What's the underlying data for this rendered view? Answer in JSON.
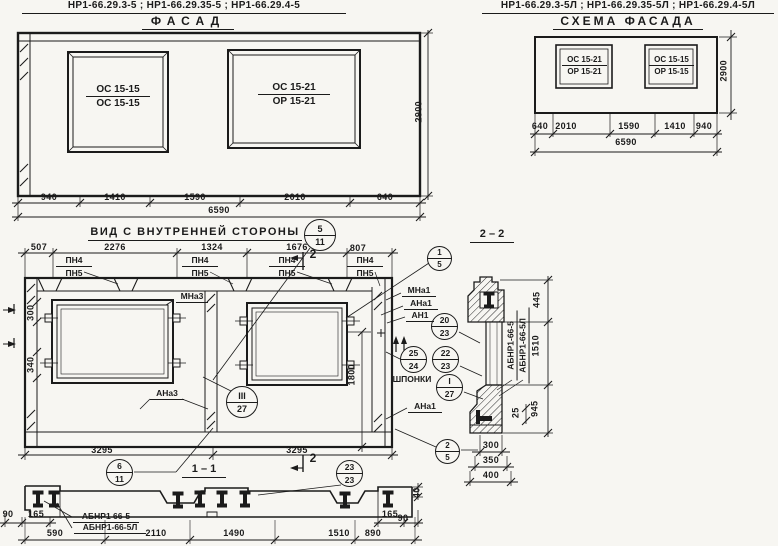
{
  "colors": {
    "ink": "#1b1b1b",
    "paper": "#f7f6f2"
  },
  "facade": {
    "codes": "НР1-66.29.3-5 ; НР1-66.29.35-5 ; НР1-66.29.4-5",
    "title": "ФАСАД",
    "win_left": {
      "top": "ОС 15-15",
      "bottom": "ОС 15-15"
    },
    "win_right": {
      "top": "ОС 15-21",
      "bottom": "ОР 15-21"
    },
    "dims": [
      "940",
      "1410",
      "1590",
      "2010",
      "640"
    ],
    "total": "6590",
    "height": "2900"
  },
  "schema": {
    "codes": "НР1-66.29.3-5Л ; НР1-66.29.35-5Л ; НР1-66.29.4-5Л",
    "title": "СХЕМА ФАСАДА",
    "win_left": {
      "top": "ОС 15-21",
      "bottom": "ОР 15-21"
    },
    "win_right": {
      "top": "ОС 15-15",
      "bottom": "ОР 15-15"
    },
    "dims": [
      "640",
      "2010",
      "1590",
      "1410",
      "940"
    ],
    "total": "6590",
    "height": "2900"
  },
  "inner": {
    "title": "ВИД С ВНУТРЕННЕЙ СТОРОНЫ",
    "dims_top": [
      "507",
      "2276",
      "1324",
      "1676",
      "807"
    ],
    "pn_top": "ПН4",
    "pn_bottom": "ПН5",
    "dims_bottom": [
      "3295",
      "3295"
    ],
    "dim_300": "300",
    "dim_340": "340",
    "dim_1800": "1800",
    "mna3": "МНа3",
    "ana3": "АНа3",
    "mna1": "МНа1",
    "ana1": "АНа1",
    "an1": "АН1",
    "ana1_lower": "АНа1",
    "shponki": "ШПОНКИ",
    "cut2": "2",
    "section_label": "1 – 1"
  },
  "section22": {
    "title": "2 – 2",
    "code1": "АБНР1-66-5",
    "code2": "АБНР1-66-5Л",
    "dim_1510": "1510",
    "dim_445": "445",
    "dim_25": "25",
    "dim_945": "945",
    "dims_bottom": [
      "300",
      "350",
      "400"
    ]
  },
  "section11": {
    "code1": "АБНР1 66-5",
    "code2": "АБНР1-66-5Л",
    "dims": [
      "590",
      "2110",
      "1490",
      "1510",
      "890"
    ],
    "d90l": "90",
    "d165l": "165",
    "d165r": "165",
    "d90r": "90",
    "d40": "40"
  },
  "callouts": {
    "c5_11": {
      "top": "5",
      "bottom": "11"
    },
    "c1_5": {
      "top": "1",
      "bottom": "5"
    },
    "c20_23": {
      "top": "20",
      "bottom": "23"
    },
    "c25_24": {
      "top": "25",
      "bottom": "24"
    },
    "c22_23": {
      "top": "22",
      "bottom": "23"
    },
    "ci_27": {
      "top": "I",
      "bottom": "27"
    },
    "ciii_27": {
      "top": "III",
      "bottom": "27"
    },
    "c6_11": {
      "top": "6",
      "bottom": "11"
    },
    "c23_23": {
      "top": "23",
      "bottom": "23"
    },
    "c2_5": {
      "top": "2",
      "bottom": "5"
    }
  }
}
